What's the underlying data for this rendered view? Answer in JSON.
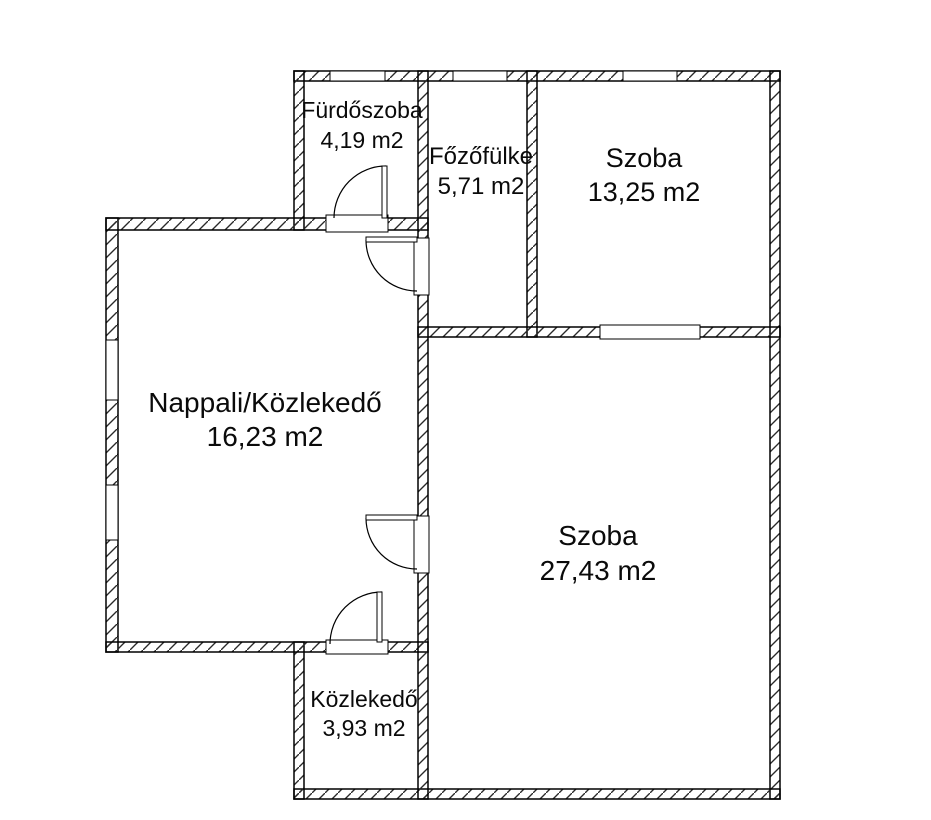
{
  "title": "Apartment floor plan",
  "units_suffix": "m2",
  "rooms": [
    {
      "id": "furdoszoba",
      "name": "Fürdőszoba",
      "area": "4,19 m2"
    },
    {
      "id": "fozofulke",
      "name": "Főzőfülke",
      "area": "5,71 m2"
    },
    {
      "id": "szoba-kicsi",
      "name": "Szoba",
      "area": "13,25 m2"
    },
    {
      "id": "nappali",
      "name": "Nappali/Közlekedő",
      "area": "16,23 m2"
    },
    {
      "id": "szoba-nagy",
      "name": "Szoba",
      "area": "27,43 m2"
    },
    {
      "id": "kozlekedo",
      "name": "Közlekedő",
      "area": "3,93 m2"
    }
  ],
  "colors": {
    "background": "#ffffff",
    "wall_line": "#000000",
    "text": "#0a0a0a"
  }
}
